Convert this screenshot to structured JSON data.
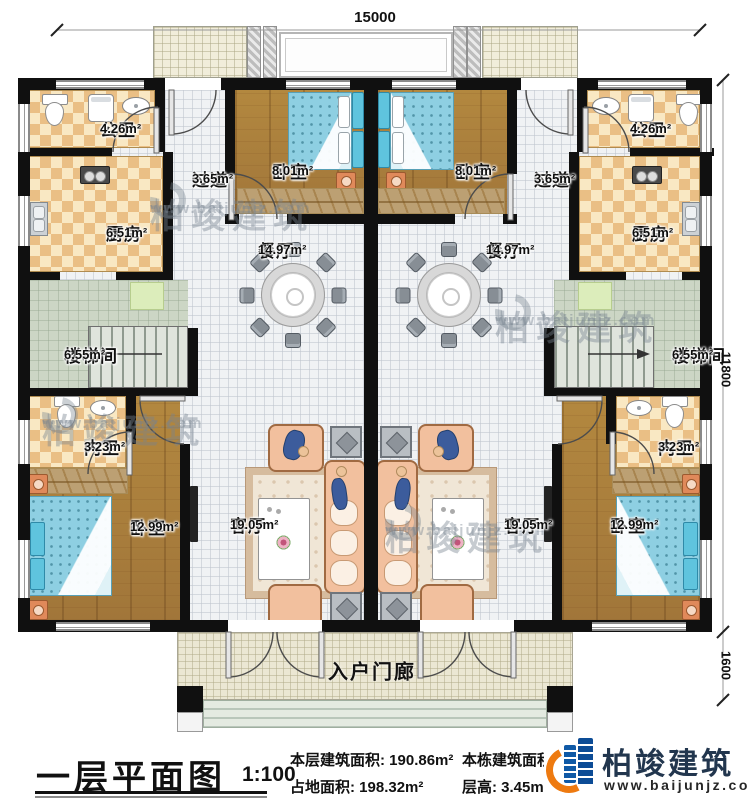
{
  "dims": {
    "top": "15000",
    "right_upper": "11800",
    "right_lower": "1600"
  },
  "rooms": {
    "left": [
      {
        "name": "公卫",
        "area": "4.26m²"
      },
      {
        "name": "过道",
        "area": "3.65m²"
      },
      {
        "name": "卧室",
        "area": "8.01m²"
      },
      {
        "name": "厨房",
        "area": "6.51m²"
      },
      {
        "name": "餐厅",
        "area": "14.97m²"
      },
      {
        "name": "楼梯间",
        "area": "6.55m²"
      },
      {
        "name": "内卫",
        "area": "3.23m²"
      },
      {
        "name": "卧室",
        "area": "12.99m²"
      },
      {
        "name": "客厅",
        "area": "19.05m²"
      }
    ],
    "right": [
      {
        "name": "公卫",
        "area": "4.26m²"
      },
      {
        "name": "过道",
        "area": "3.65m²"
      },
      {
        "name": "卧室",
        "area": "8.01m²"
      },
      {
        "name": "厨房",
        "area": "6.51m²"
      },
      {
        "name": "餐厅",
        "area": "14.97m²"
      },
      {
        "name": "楼梯间",
        "area": "6.55m²"
      },
      {
        "name": "内卫",
        "area": "3.23m²"
      },
      {
        "name": "卧室",
        "area": "12.99m²"
      },
      {
        "name": "客厅",
        "area": "19.05m²"
      }
    ],
    "porch": {
      "name": "入户门廊"
    }
  },
  "footer": {
    "title": "一层平面图",
    "scale": "1:100",
    "stats": [
      {
        "label": "本层建筑面积: ",
        "value": "190.86m²"
      },
      {
        "label": "占地面积: ",
        "value": "198.32m²"
      },
      {
        "label": "本栋建筑面积: ",
        "value": ""
      },
      {
        "label": "层高: ",
        "value": "3.45m"
      }
    ]
  },
  "watermark": {
    "brand": "柏竣建筑",
    "url": "www.baijunjz.com"
  },
  "logo": {
    "brand": "柏竣建筑",
    "url": "www.baijunjz.com"
  }
}
